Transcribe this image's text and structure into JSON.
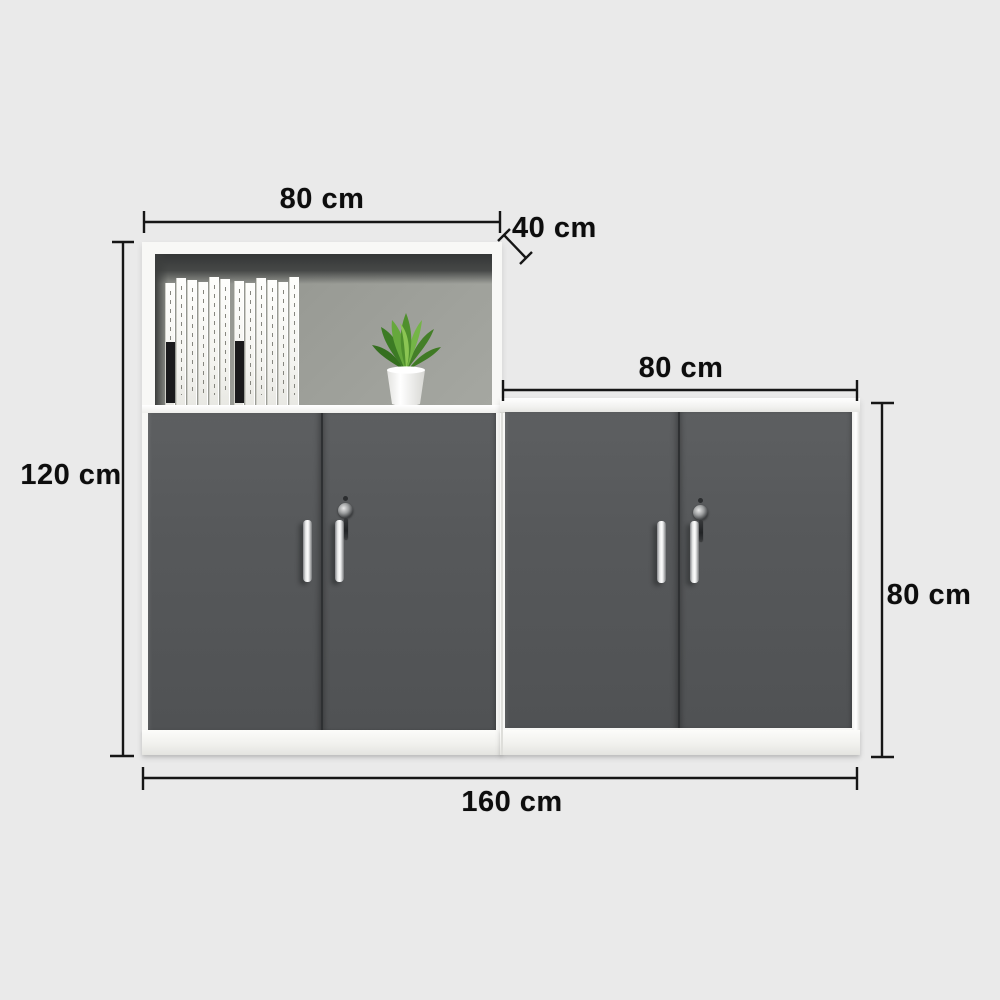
{
  "title": "cabinet-dimension-diagram",
  "dimensions": {
    "left_width": "80 cm",
    "depth": "40 cm",
    "right_width": "80 cm",
    "left_height": "120 cm",
    "right_height": "80 cm",
    "total_width": "160 cm"
  },
  "furniture": {
    "left_unit": {
      "type": "tall cabinet with open shelf and two lockable doors",
      "books_count": 12,
      "black_label_spines": [
        0,
        6
      ],
      "has_plant": true
    },
    "right_unit": {
      "type": "low cabinet with two lockable doors"
    }
  },
  "colors": {
    "background": "#eaeaea",
    "dimension_line": "#161616",
    "label_text": "#0d0d0d",
    "door_gray": "#57595b",
    "shelf_back": "#9a9c96",
    "frame_white": "#f8f8f6",
    "plant_green": "#5a9e33",
    "pot_white": "#fcfcfb",
    "handle_chrome": "#d9dadb"
  }
}
